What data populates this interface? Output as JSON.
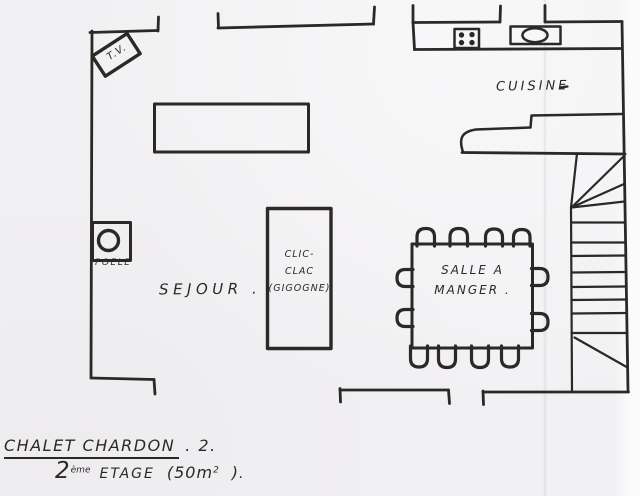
{
  "labels": {
    "tv": "T.V.",
    "cuisine": "CUISINE",
    "sejour": "SEJOUR .",
    "salle_line1": "SALLE A",
    "salle_line2": "MANGER .",
    "clic_line1": "CLIC-",
    "clic_line2": "CLAC",
    "clic_line3": "(GIGOGNE)",
    "poele": "POELE"
  },
  "title": {
    "name": "CHALET CHARDON",
    "suffix": ". 2.",
    "floor_num": "2",
    "floor_sup": "ème",
    "floor_word": "ETAGE",
    "area_main": "(50m",
    "area_sup": "2",
    "area_close": ")",
    "line2_end": "."
  },
  "colors": {
    "ink": "#2b2926",
    "paper": "#f1f0f2"
  }
}
